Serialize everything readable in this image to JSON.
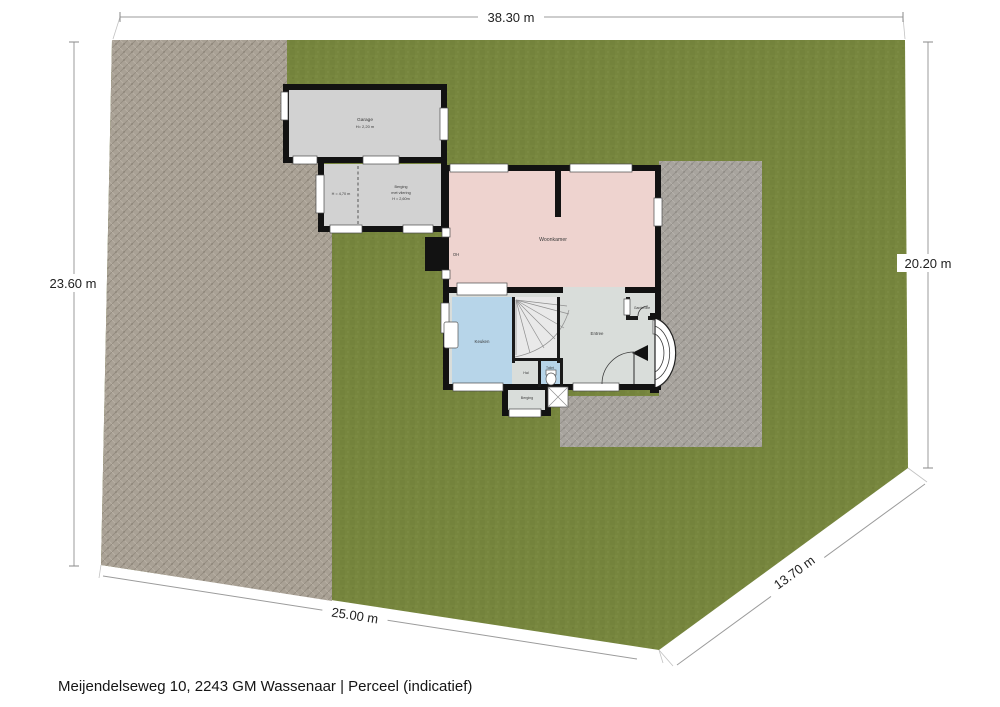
{
  "page": {
    "caption": "Meijendelseweg 10, 2243 GM Wassenaar | Perceel (indicatief)"
  },
  "dimensions": {
    "top": "38.30 m",
    "left": "23.60 m",
    "right": "20.20 m",
    "bottom": "25.00 m",
    "diagonal": "13.70 m"
  },
  "rooms": {
    "garage": {
      "name": "Garage",
      "height": "H= 2,20 m"
    },
    "berging": {
      "name": "Berging",
      "note": "met vliering",
      "height": "H = 2,60m",
      "side_height": "H = 4,70 m"
    },
    "woonkamer": {
      "name": "Woonkamer",
      "fireplace": "OH"
    },
    "keuken": {
      "name": "Keuken"
    },
    "entree": {
      "name": "Entree"
    },
    "garderobe": {
      "name": "Garderobe"
    },
    "hal": {
      "name": "Hal"
    },
    "toilet": {
      "name": "Toilet"
    },
    "berging_klein": {
      "name": "Berging"
    }
  },
  "colors": {
    "grass": "#77863e",
    "grass_dark": "#6d7c37",
    "paving_left": "#a9a195",
    "paving_right": "#a8a49e",
    "wall": "#121212",
    "room_gray": "#d2d2d2",
    "room_light": "#d9ddda",
    "woonkamer": "#eed3cf",
    "water_blue": "#b7d5e9",
    "stairs": "#e9e9e9",
    "dim_line": "#9b9b9b",
    "text": "#1c1c1c"
  }
}
